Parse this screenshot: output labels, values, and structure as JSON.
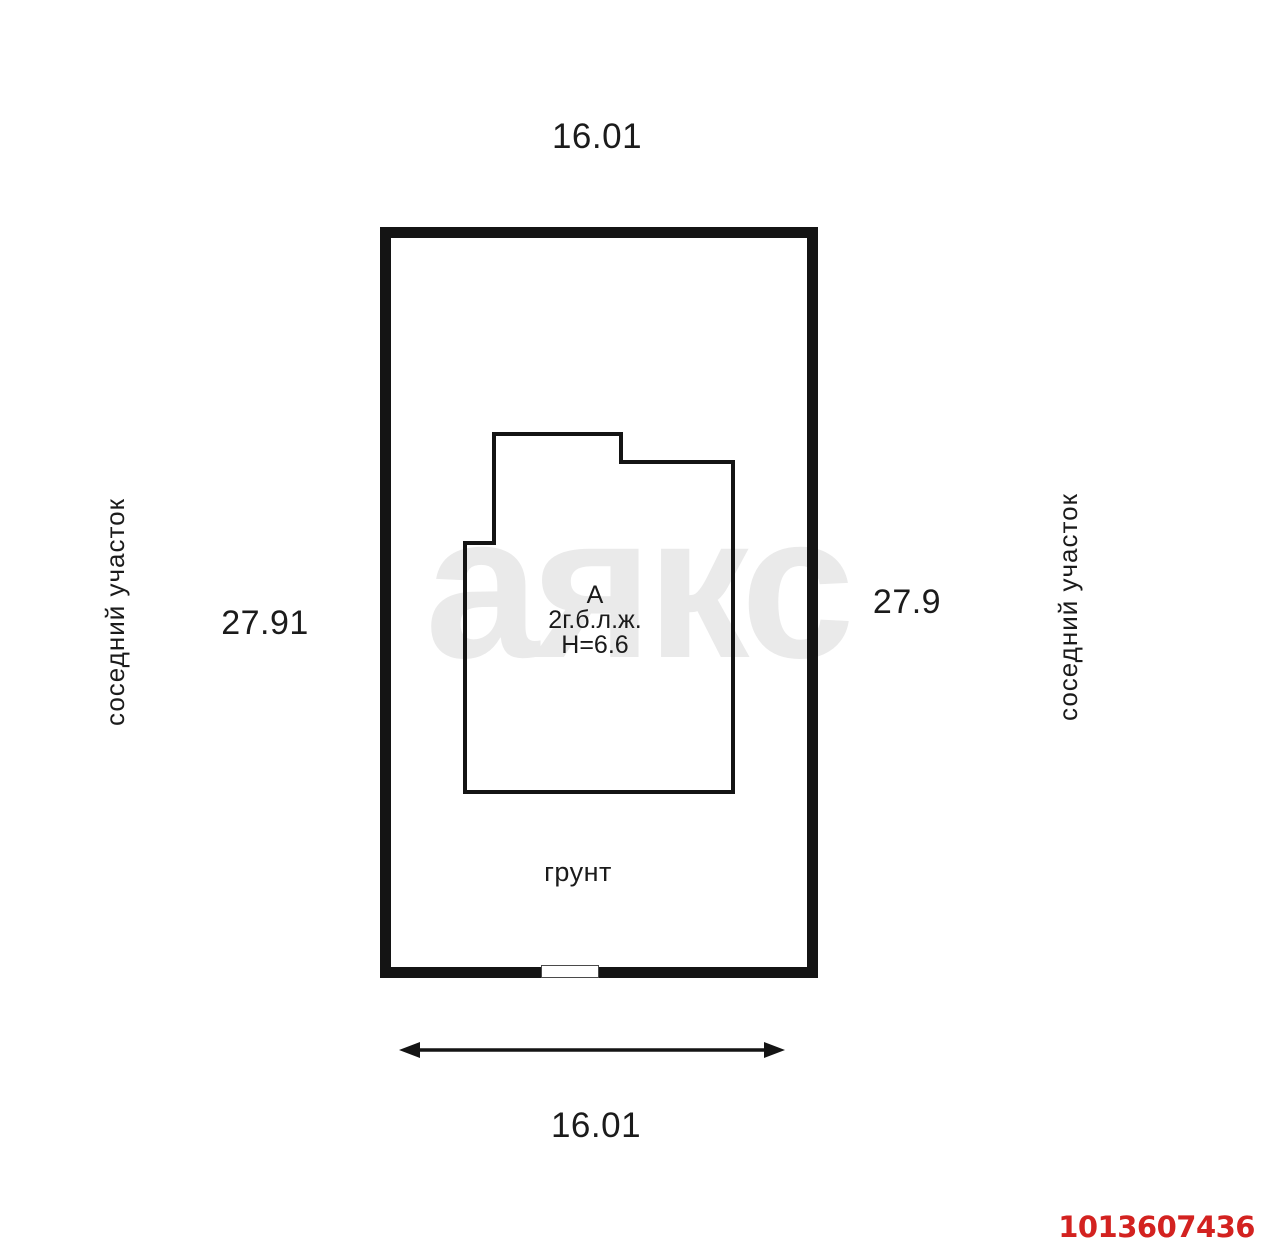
{
  "watermark": "аякс",
  "listing_id": "1013607436",
  "dimensions": {
    "top": "16.01",
    "bottom": "16.01",
    "left": "27.91",
    "right": "27.9"
  },
  "neighbors": {
    "left": "соседний участок",
    "right": "соседний участок"
  },
  "ground_label": "грунт",
  "building": {
    "letter": "А",
    "type": "2г.б.л.ж.",
    "height": "Н=6.6"
  },
  "colors": {
    "line": "#141414",
    "watermark": "#eaeaea",
    "listing-id": "#d32220"
  }
}
